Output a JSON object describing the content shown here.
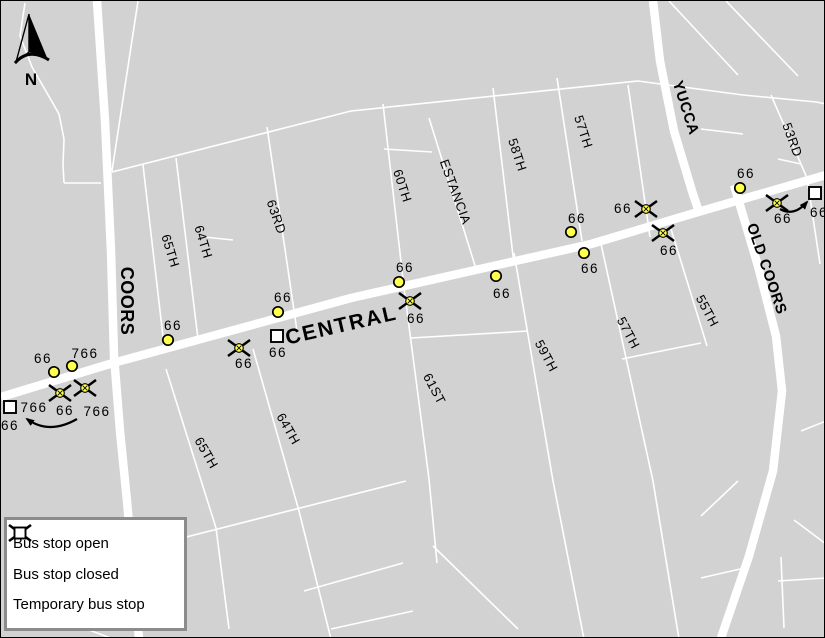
{
  "legend": {
    "items": [
      {
        "icon": "bus-stop-open-icon",
        "type": "open",
        "label": "Bus stop open"
      },
      {
        "icon": "bus-stop-closed-icon",
        "type": "closed",
        "label": "Bus stop closed"
      },
      {
        "icon": "temporary-bus-stop-icon",
        "type": "temporary",
        "label": "Temporary bus stop"
      }
    ]
  },
  "compass": {
    "label": "N"
  },
  "map": {
    "colors": {
      "background": "#d2d2d2",
      "road": "#ffffff",
      "stop_fill": "#ffff4d",
      "stop_stroke": "#000000",
      "label": "#000000"
    },
    "roads": {
      "major": [
        {
          "name": "central",
          "points": [
            [
              0,
              396
            ],
            [
              112,
              362
            ],
            [
              350,
              297
            ],
            [
              590,
              243
            ],
            [
              697,
              211
            ],
            [
              825,
              174
            ]
          ]
        },
        {
          "name": "coors",
          "points": [
            [
              96,
              0
            ],
            [
              104,
              120
            ],
            [
              110,
              250
            ],
            [
              113,
              355
            ],
            [
              119,
              430
            ],
            [
              126,
              500
            ],
            [
              138,
              638
            ]
          ]
        },
        {
          "name": "yucca",
          "points": [
            [
              652,
              0
            ],
            [
              659,
              60
            ],
            [
              673,
              130
            ],
            [
              691,
              190
            ],
            [
              699,
              214
            ]
          ]
        },
        {
          "name": "old-coors",
          "points": [
            [
              733,
              184
            ],
            [
              757,
              265
            ],
            [
              775,
              335
            ],
            [
              781,
              390
            ],
            [
              772,
              470
            ],
            [
              748,
              555
            ],
            [
              720,
              637
            ]
          ]
        }
      ],
      "minor": [
        [
          [
            24,
            2
          ],
          [
            19,
            35
          ],
          [
            31,
            66
          ],
          [
            46,
            92
          ],
          [
            58,
            113
          ],
          [
            63,
            138
          ],
          [
            62,
            164
          ],
          [
            63,
            182
          ]
        ],
        [
          [
            63,
            182
          ],
          [
            100,
            182
          ]
        ],
        [
          [
            137,
            0
          ],
          [
            111,
            170
          ]
        ],
        [
          [
            111,
            171
          ],
          [
            350,
            110
          ],
          [
            637,
            80
          ],
          [
            742,
            94
          ],
          [
            815,
            101
          ],
          [
            825,
            103
          ]
        ],
        [
          [
            142,
            164
          ],
          [
            163,
            344
          ]
        ],
        [
          [
            175,
            157
          ],
          [
            197,
            338
          ]
        ],
        [
          [
            266,
            126
          ],
          [
            296,
            330
          ]
        ],
        [
          [
            382,
            103
          ],
          [
            403,
            287
          ],
          [
            428,
            478
          ],
          [
            436,
            562
          ]
        ],
        [
          [
            383,
            148
          ],
          [
            431,
            151
          ]
        ],
        [
          [
            428,
            117
          ],
          [
            476,
            271
          ]
        ],
        [
          [
            492,
            87
          ],
          [
            513,
            263
          ]
        ],
        [
          [
            556,
            77
          ],
          [
            581,
            240
          ]
        ],
        [
          [
            627,
            84
          ],
          [
            649,
            236
          ]
        ],
        [
          [
            770,
            94
          ],
          [
            806,
            177
          ],
          [
            819,
            263
          ]
        ],
        [
          [
            165,
            368
          ],
          [
            215,
            527
          ],
          [
            228,
            628
          ]
        ],
        [
          [
            252,
            348
          ],
          [
            298,
            510
          ],
          [
            330,
            638
          ]
        ],
        [
          [
            513,
            252
          ],
          [
            552,
            480
          ],
          [
            583,
            638
          ]
        ],
        [
          [
            600,
            243
          ],
          [
            652,
            480
          ],
          [
            678,
            638
          ]
        ],
        [
          [
            670,
            228
          ],
          [
            706,
            345
          ]
        ],
        [
          [
            150,
            545
          ],
          [
            405,
            480
          ]
        ],
        [
          [
            432,
            545
          ],
          [
            517,
            628
          ]
        ],
        [
          [
            303,
            590
          ],
          [
            402,
            562
          ]
        ],
        [
          [
            330,
            628
          ],
          [
            412,
            610
          ]
        ],
        [
          [
            75,
            624
          ],
          [
            112,
            638
          ]
        ],
        [
          [
            700,
            128
          ],
          [
            742,
            133
          ]
        ],
        [
          [
            777,
            158
          ],
          [
            800,
            163
          ]
        ],
        [
          [
            668,
            0
          ],
          [
            737,
            74
          ]
        ],
        [
          [
            725,
            0
          ],
          [
            797,
            75
          ]
        ],
        [
          [
            700,
            515
          ],
          [
            737,
            480
          ]
        ],
        [
          [
            780,
            556
          ],
          [
            783,
            627
          ]
        ],
        [
          [
            777,
            580
          ],
          [
            825,
            577
          ]
        ],
        [
          [
            700,
            577
          ],
          [
            748,
            566
          ]
        ],
        [
          [
            621,
            358
          ],
          [
            700,
            342
          ]
        ],
        [
          [
            410,
            337
          ],
          [
            527,
            330
          ]
        ],
        [
          [
            203,
            236
          ],
          [
            232,
            239
          ]
        ],
        [
          [
            800,
            430
          ],
          [
            825,
            420
          ]
        ],
        [
          [
            793,
            519
          ],
          [
            825,
            543
          ]
        ]
      ]
    },
    "street_labels": [
      {
        "text": "COORS",
        "x": 124,
        "y": 300,
        "angle": 90,
        "bold": true,
        "size": 18
      },
      {
        "text": "CENTRAL",
        "x": 341,
        "y": 327,
        "angle": -13,
        "bold": true,
        "size": 21,
        "spacing": 2
      },
      {
        "text": "YUCCA",
        "x": 684,
        "y": 107,
        "angle": 72,
        "bold": true,
        "size": 15
      },
      {
        "text": "OLD COORS",
        "x": 765,
        "y": 268,
        "angle": 71,
        "bold": true,
        "size": 15
      },
      {
        "text": "65TH",
        "x": 169,
        "y": 250,
        "angle": 73
      },
      {
        "text": "64TH",
        "x": 202,
        "y": 241,
        "angle": 73
      },
      {
        "text": "63RD",
        "x": 275,
        "y": 216,
        "angle": 71
      },
      {
        "text": "60TH",
        "x": 401,
        "y": 185,
        "angle": 72
      },
      {
        "text": "ESTANCIA",
        "x": 454,
        "y": 191,
        "angle": 70
      },
      {
        "text": "58TH",
        "x": 516,
        "y": 154,
        "angle": 72
      },
      {
        "text": "57TH",
        "x": 582,
        "y": 131,
        "angle": 72
      },
      {
        "text": "53RD",
        "x": 791,
        "y": 139,
        "angle": 70
      },
      {
        "text": "65TH",
        "x": 205,
        "y": 452,
        "angle": 60
      },
      {
        "text": "64TH",
        "x": 287,
        "y": 428,
        "angle": 60
      },
      {
        "text": "61ST",
        "x": 433,
        "y": 388,
        "angle": 62
      },
      {
        "text": "59TH",
        "x": 545,
        "y": 355,
        "angle": 62
      },
      {
        "text": "57TH",
        "x": 627,
        "y": 332,
        "angle": 62
      },
      {
        "text": "55TH",
        "x": 706,
        "y": 310,
        "angle": 62
      }
    ],
    "stops": [
      {
        "type": "open",
        "x": 53,
        "y": 371,
        "labels": [
          {
            "text": "66",
            "x": 42,
            "y": 362
          }
        ]
      },
      {
        "type": "open",
        "x": 71,
        "y": 365,
        "labels": [
          {
            "text": "766",
            "x": 84,
            "y": 357
          }
        ]
      },
      {
        "type": "open",
        "x": 167,
        "y": 339,
        "labels": [
          {
            "text": "66",
            "x": 172,
            "y": 329
          }
        ]
      },
      {
        "type": "open",
        "x": 277,
        "y": 311,
        "labels": [
          {
            "text": "66",
            "x": 282,
            "y": 301
          }
        ]
      },
      {
        "type": "open",
        "x": 398,
        "y": 281,
        "labels": [
          {
            "text": "66",
            "x": 404,
            "y": 271
          }
        ]
      },
      {
        "type": "open",
        "x": 495,
        "y": 275,
        "labels": [
          {
            "text": "66",
            "x": 501,
            "y": 297
          }
        ]
      },
      {
        "type": "open",
        "x": 570,
        "y": 231,
        "labels": [
          {
            "text": "66",
            "x": 576,
            "y": 222
          }
        ]
      },
      {
        "type": "open",
        "x": 583,
        "y": 252,
        "labels": [
          {
            "text": "66",
            "x": 589,
            "y": 272
          }
        ]
      },
      {
        "type": "open",
        "x": 739,
        "y": 187,
        "labels": [
          {
            "text": "66",
            "x": 745,
            "y": 177
          }
        ]
      },
      {
        "type": "closed",
        "x": 59,
        "y": 392,
        "labels": [
          {
            "text": "66",
            "x": 64,
            "y": 414
          }
        ]
      },
      {
        "type": "closed",
        "x": 84,
        "y": 387,
        "labels": [
          {
            "text": "766",
            "x": 96,
            "y": 415
          }
        ]
      },
      {
        "type": "closed",
        "x": 238,
        "y": 347,
        "labels": [
          {
            "text": "66",
            "x": 243,
            "y": 367
          }
        ]
      },
      {
        "type": "closed",
        "x": 409,
        "y": 300,
        "labels": [
          {
            "text": "66",
            "x": 415,
            "y": 322
          }
        ]
      },
      {
        "type": "closed",
        "x": 645,
        "y": 208,
        "labels": [
          {
            "text": "66",
            "x": 622,
            "y": 212
          }
        ]
      },
      {
        "type": "closed",
        "x": 662,
        "y": 232,
        "labels": [
          {
            "text": "66",
            "x": 668,
            "y": 254
          }
        ]
      },
      {
        "type": "closed",
        "x": 776,
        "y": 202,
        "labels": [
          {
            "text": "66",
            "x": 782,
            "y": 222
          }
        ]
      },
      {
        "type": "temporary",
        "x": 9,
        "y": 406,
        "labels": [
          {
            "text": "766",
            "x": 33,
            "y": 411
          },
          {
            "text": "66",
            "x": 9,
            "y": 429
          }
        ]
      },
      {
        "type": "temporary",
        "x": 276,
        "y": 335,
        "labels": [
          {
            "text": "66",
            "x": 277,
            "y": 356
          }
        ]
      },
      {
        "type": "temporary",
        "x": 814,
        "y": 192,
        "labels": [
          {
            "text": "66",
            "x": 818,
            "y": 216
          }
        ]
      }
    ],
    "arrows": [
      {
        "name": "relocation-arrow-west",
        "path": "M 76 418 Q 48 434 26 418"
      },
      {
        "name": "relocation-arrow-east",
        "path": "M 779 208 Q 793 216 806 201"
      }
    ]
  }
}
